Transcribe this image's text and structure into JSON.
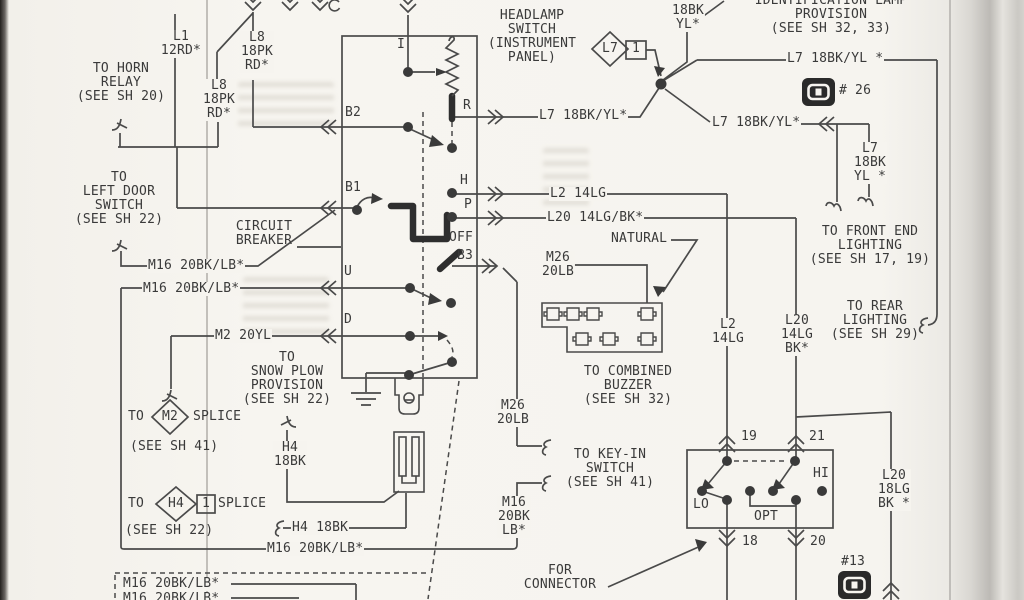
{
  "figure": {
    "kind": "scanned vehicle wiring diagram page",
    "subject": "HEADLAMP SWITCH (INSTRUMENT PANEL)"
  },
  "colors": {
    "ink": "#3a3a3a",
    "line": "#4a4a4a",
    "thick": "#2e2e2e",
    "paper": "#f6f4ef"
  },
  "labels": {
    "l1": [
      "L1",
      "12RD*"
    ],
    "horn": [
      "TO HORN",
      "RELAY",
      "(SEE SH 20)"
    ],
    "l8_wire": [
      "L8",
      "18PK",
      "RD*"
    ],
    "door": [
      "TO",
      "LEFT DOOR",
      "SWITCH",
      "(SEE SH 22)"
    ],
    "breaker": [
      "CIRCUIT",
      "BREAKER"
    ],
    "m16_wire": "M16 20BK/LB*",
    "m2_wire": "M2 20YL",
    "snow": [
      "TO",
      "SNOW PLOW",
      "PROVISION",
      "(SEE SH 22)"
    ],
    "to_word": "TO",
    "splice_word": "SPLICE",
    "see41": "(SEE SH 41)",
    "see22": "(SEE SH 22)",
    "m2_tag": "M2",
    "h4_tag": "H4",
    "one": "1",
    "h4_stack": [
      "H4",
      "18BK"
    ],
    "h4_line": "H4 18BK",
    "headlamp": [
      "HEADLAMP",
      "SWITCH",
      "(INSTRUMENT",
      "PANEL)"
    ],
    "term_i": "I",
    "term_b2": "B2",
    "term_b1": "B1",
    "term_u": "U",
    "term_d": "D",
    "term_r": "R",
    "term_h": "H",
    "term_p": "P",
    "term_off": "OFF",
    "term_b3": "B3",
    "l7_r": "L7 18BK/YL*",
    "l2_h": "L2 14LG",
    "l20_h": "L20 14LG/BK*",
    "natural": "NATURAL",
    "m26_wire": [
      "M26",
      "20LB"
    ],
    "buzzer": [
      "TO COMBINED",
      "BUZZER",
      "(SEE SH 32)"
    ],
    "keyin": [
      "TO KEY-IN",
      "SWITCH",
      "(SEE SH 41)"
    ],
    "m16_v": [
      "M16",
      "20BK",
      "LB*"
    ],
    "forconn": [
      "FOR",
      "CONNECTOR"
    ],
    "ident": [
      "IDENTIFICATION LAMP",
      "PROVISION",
      "(SEE SH 32, 33)"
    ],
    "l7_top": [
      "L7",
      "18BK",
      "YL*"
    ],
    "l7_tag": "L7",
    "l7_h": "L7 18BK/YL *",
    "no26": "# 26",
    "l7_c": "L7 18BK/YL*",
    "l7_v": [
      "L7",
      "18BK",
      "YL *"
    ],
    "front": [
      "TO FRONT END",
      "LIGHTING",
      "(SEE SH 17, 19)"
    ],
    "rear": [
      "TO REAR",
      "LIGHTING",
      "(SEE SH 29)"
    ],
    "l2_v": [
      "L2",
      "14LG"
    ],
    "l20_v": [
      "L20",
      "14LG",
      "BK*"
    ],
    "p19": "19",
    "p21": "21",
    "p18": "18",
    "p20": "20",
    "lo": "LO",
    "opt": "OPT",
    "hi": "HI",
    "l20_b": [
      "L20",
      "18LG",
      "BK *"
    ],
    "no13": "#13"
  }
}
